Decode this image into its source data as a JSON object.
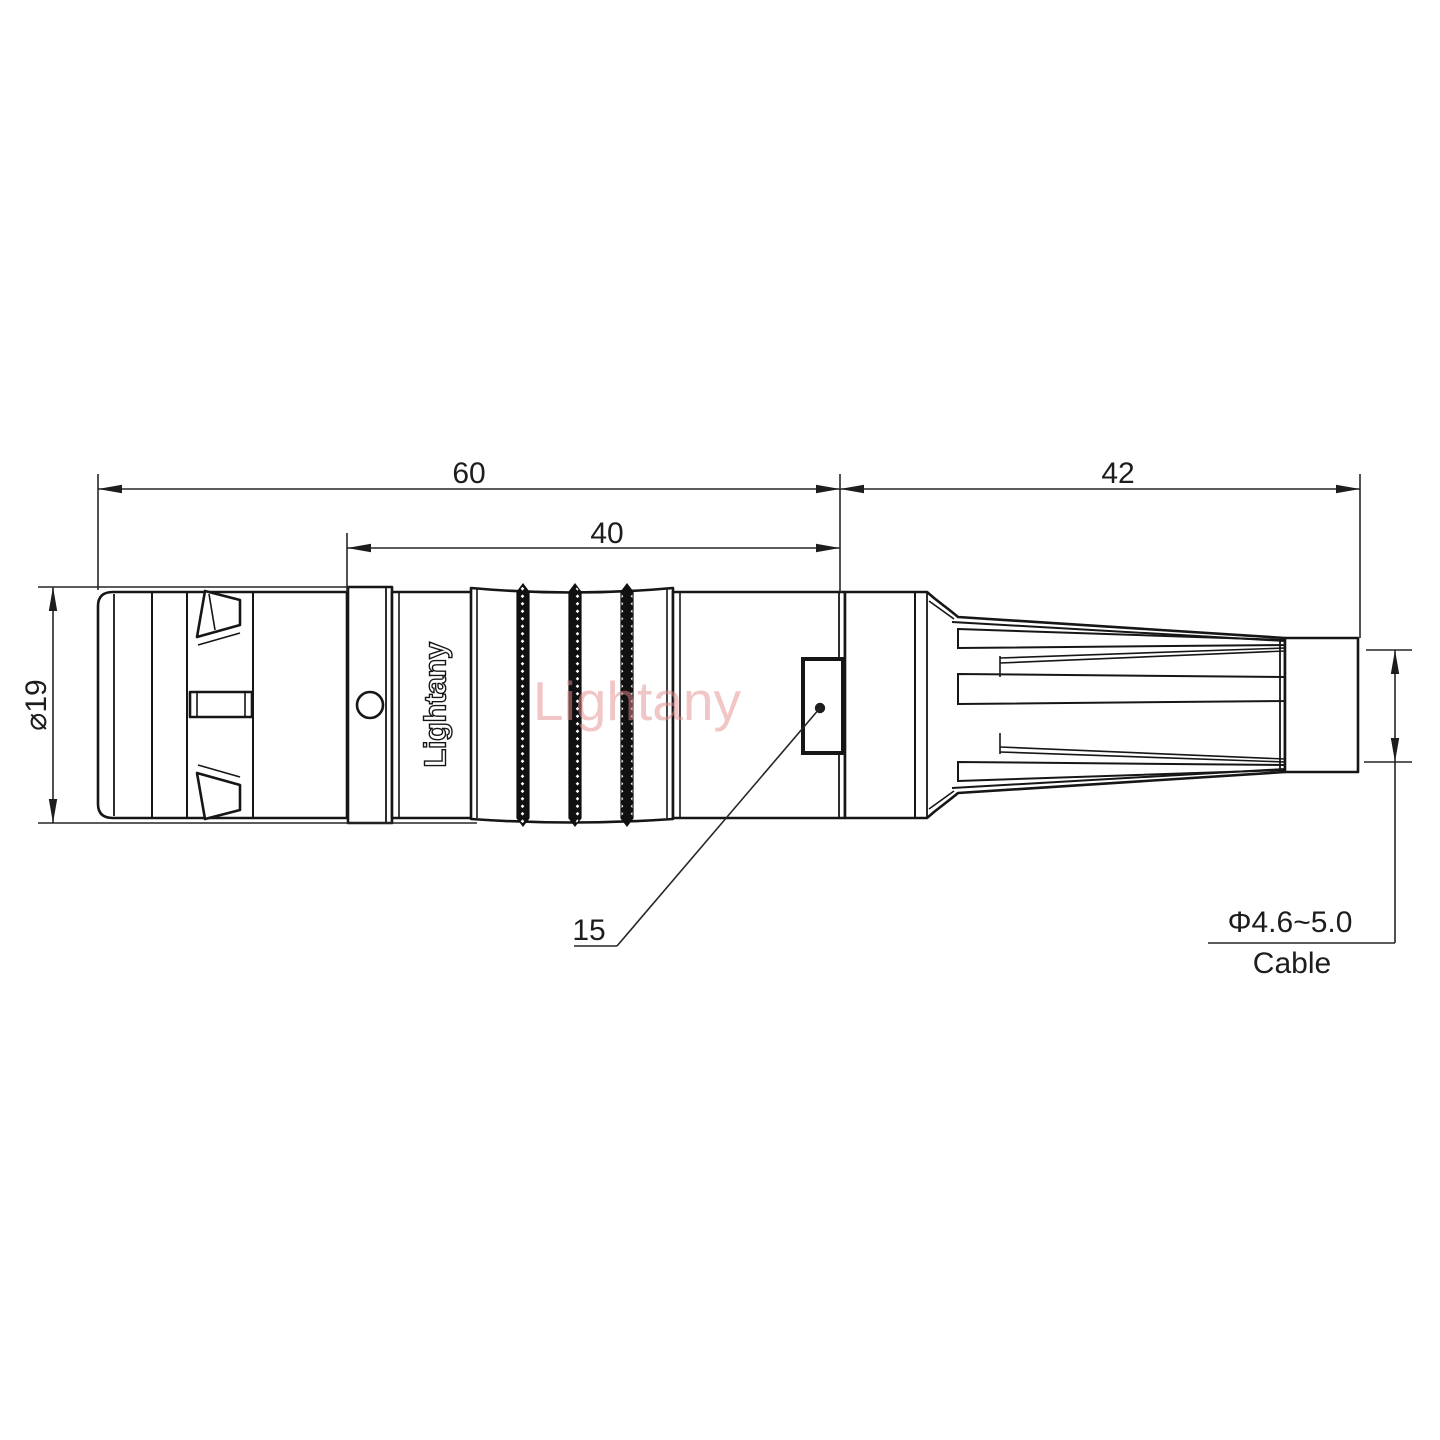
{
  "drawing": {
    "type": "technical-dimension-drawing",
    "subject": "circular push-pull connector with strain relief boot, side view",
    "brand_engraving": "Lightany",
    "watermark": "Lightany",
    "dims": {
      "overall_length": "60",
      "grip_length": "40",
      "boot_length": "42",
      "shell_diameter": "⌀19",
      "key_detail": "15",
      "cable_range": "Φ4.6~5.0",
      "cable_word": "Cable"
    },
    "colors": {
      "line": "#161616",
      "dimension": "#262626",
      "watermark": "#e58f8f",
      "background": "#ffffff"
    }
  }
}
